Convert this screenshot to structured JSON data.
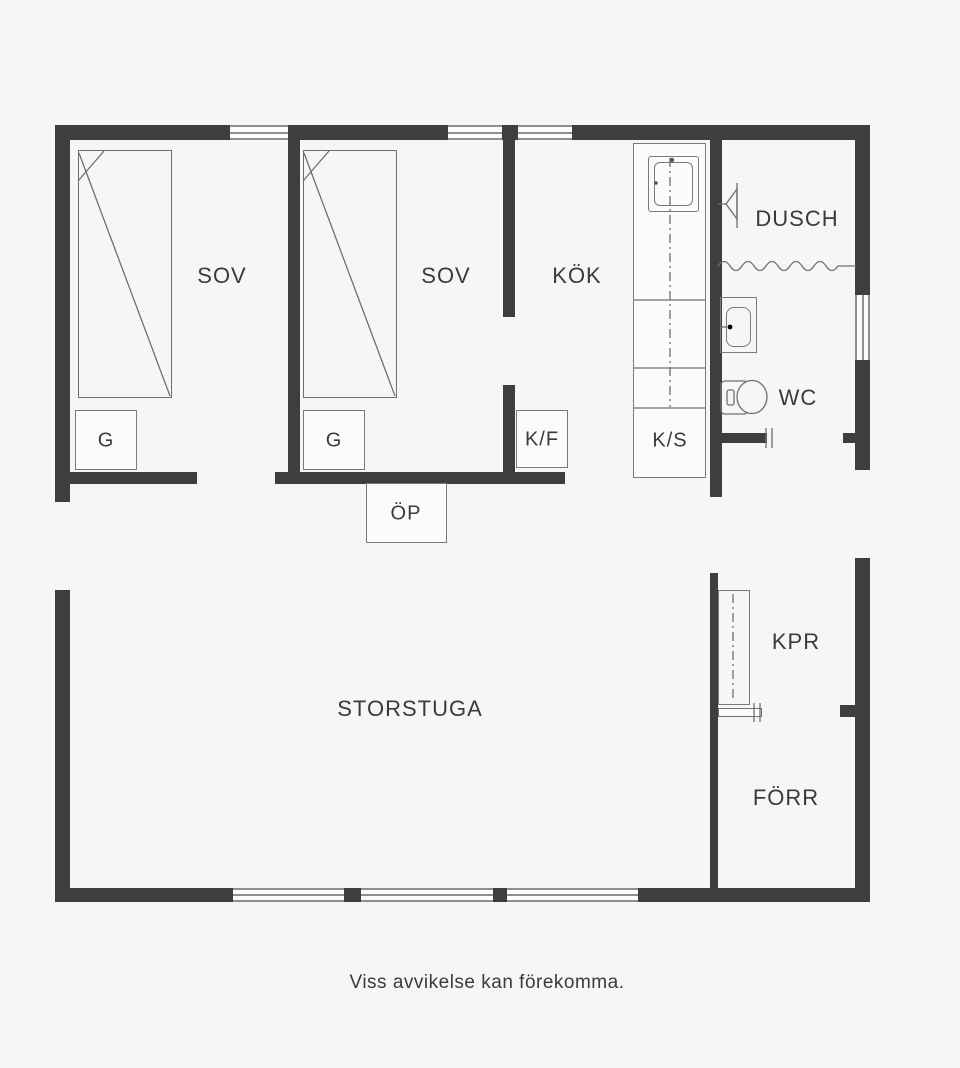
{
  "type": "floor-plan",
  "colors": {
    "wall": "#3e3e3e",
    "background": "#f6f6f5",
    "line": "#6f6f6f",
    "text": "#3a3a3a"
  },
  "rooms": {
    "sov1": {
      "label": "SOV"
    },
    "sov2": {
      "label": "SOV"
    },
    "kok": {
      "label": "KÖK"
    },
    "dusch": {
      "label": "DUSCH"
    },
    "wc": {
      "label": "WC"
    },
    "storstuga": {
      "label": "STORSTUGA"
    },
    "kpr": {
      "label": "KPR"
    },
    "forr": {
      "label": "FÖRR"
    }
  },
  "fixtures": {
    "wardrobe1": {
      "label": "G"
    },
    "wardrobe2": {
      "label": "G"
    },
    "fridge_freezer": {
      "label": "K/F"
    },
    "pantry_cabinet": {
      "label": "K/S"
    },
    "fireplace": {
      "label": "ÖP"
    }
  },
  "footer": {
    "disclaimer": "Viss avvikelse kan förekomma."
  }
}
